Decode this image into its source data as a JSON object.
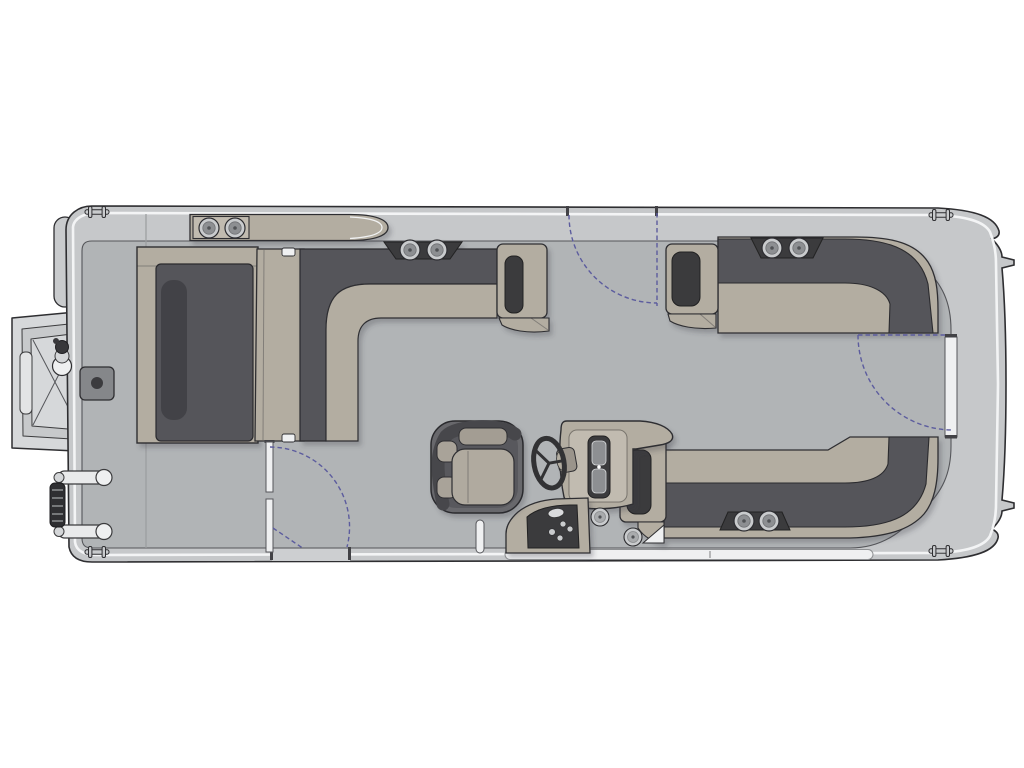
{
  "diagram": {
    "type": "boat-deck-floor-plan",
    "subject": "pontoon boat",
    "view": "top-down",
    "orientation": "bow-left-stern-right",
    "sections": {
      "bow": {
        "features": [
          "open-boarding-gate-ramp",
          "navigation-light",
          "deck-hatch",
          "boarding-ladder",
          "counter-with-cupholders",
          "port-couch",
          "walkthrough-backrest",
          "l-shaped-lounge",
          "armrest"
        ]
      },
      "midship": {
        "features": [
          "starboard-l-lounge",
          "armrest",
          "starboard-gate-with-swing-arc",
          "port-gate-with-swing-arc"
        ]
      },
      "helm": {
        "features": [
          "captains-chair",
          "steering-wheel",
          "console-with-gauges",
          "switch-panel",
          "speakers",
          "ski-pylon"
        ]
      },
      "stern": {
        "features": [
          "stern-l-bench",
          "armrest",
          "stern-gate-with-swing-arc",
          "swim-platform",
          "corner-cleats"
        ]
      }
    },
    "counts": {
      "cupholders": 8,
      "speakers": 2,
      "gates": 4,
      "cleats": 4,
      "swing_arcs": 3,
      "gauges": 2
    }
  },
  "palette": {
    "background": "#ffffff",
    "hull": "#c6c8ca",
    "deck": "#b1b4b6",
    "rub_rail": "#f3f4f5",
    "outline": "#2e2e31",
    "seat_tan": "#b3ada1",
    "seat_tan_light": "#c1bbb0",
    "upholstery_dark": "#55555a",
    "upholstery_darker": "#424246",
    "console_dark": "#3a3a3e",
    "metal": "#c9cbcd",
    "metal_dark": "#8d8f92",
    "white_detail": "#eff0f1",
    "chair_dark": "#68686c",
    "swing_arc": "#5c5c9e"
  }
}
